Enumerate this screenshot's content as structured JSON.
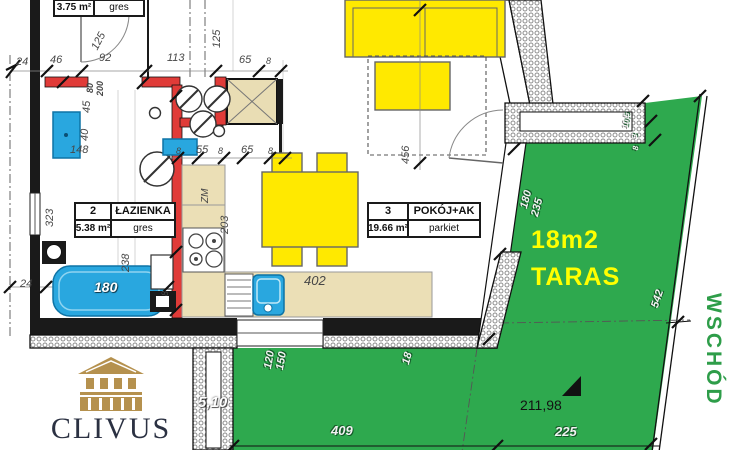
{
  "plan": {
    "rooms": [
      {
        "no": "",
        "name": "",
        "area": "3.75 m²",
        "floor": "gres"
      },
      {
        "no": "2",
        "name": "ŁAZIENKA",
        "area": "5.38 m²",
        "floor": "gres"
      },
      {
        "no": "3",
        "name": "POKÓJ+AK",
        "area": "19.66 m²",
        "floor": "parkiet"
      }
    ],
    "terrace": {
      "size_label": "18m2",
      "name": "TARAS",
      "elevation": "211,98"
    },
    "compass_label": "WSCHÓD",
    "brand": "CLIVUS"
  },
  "dims": [
    {
      "t": "24",
      "x": 16,
      "y": 57
    },
    {
      "t": "46",
      "x": 50,
      "y": 55
    },
    {
      "t": "92",
      "x": 99,
      "y": 53
    },
    {
      "t": "113",
      "x": 167,
      "y": 53
    },
    {
      "t": "65",
      "x": 239,
      "y": 55
    },
    {
      "t": "8",
      "x": 266,
      "y": 57,
      "s": 9
    },
    {
      "t": "125",
      "x": 90,
      "y": 47,
      "r": -62
    },
    {
      "t": "125",
      "x": 212,
      "y": 48,
      "r": -90
    },
    {
      "t": "80",
      "x": 86,
      "y": 93,
      "r": -90,
      "s": 9,
      "b": 1
    },
    {
      "t": "200",
      "x": 96,
      "y": 96,
      "r": -90,
      "s": 9,
      "b": 1
    },
    {
      "t": "45",
      "x": 82,
      "y": 113,
      "r": -90
    },
    {
      "t": "40",
      "x": 80,
      "y": 141,
      "r": -90
    },
    {
      "t": "148",
      "x": 70,
      "y": 145
    },
    {
      "t": "8",
      "x": 176,
      "y": 147,
      "s": 9
    },
    {
      "t": "55",
      "x": 196,
      "y": 145
    },
    {
      "t": "8",
      "x": 218,
      "y": 147,
      "s": 9
    },
    {
      "t": "65",
      "x": 241,
      "y": 145
    },
    {
      "t": "8",
      "x": 268,
      "y": 147,
      "s": 9
    },
    {
      "t": "323",
      "x": 45,
      "y": 227,
      "r": -90
    },
    {
      "t": "238",
      "x": 121,
      "y": 272,
      "r": -90
    },
    {
      "t": "24",
      "x": 20,
      "y": 279
    },
    {
      "t": "8",
      "x": 161,
      "y": 296,
      "r": -90,
      "s": 9
    },
    {
      "t": "ZM",
      "x": 201,
      "y": 203,
      "r": -90,
      "s": 10
    },
    {
      "t": "203",
      "x": 220,
      "y": 234,
      "r": -90
    },
    {
      "t": "402",
      "x": 304,
      "y": 274,
      "s": 13
    },
    {
      "t": "456",
      "x": 401,
      "y": 164,
      "r": -90
    },
    {
      "t": "180",
      "x": 94,
      "y": 280,
      "c": "wht",
      "s": 14
    },
    {
      "t": "180",
      "x": 519,
      "y": 207,
      "r": -75,
      "c": "emb"
    },
    {
      "t": "235",
      "x": 530,
      "y": 215,
      "r": -75,
      "c": "emb"
    },
    {
      "t": "542",
      "x": 650,
      "y": 306,
      "r": -72,
      "c": "emb"
    },
    {
      "t": "10,5",
      "x": 622,
      "y": 128,
      "r": -85,
      "c": "emb",
      "s": 8
    },
    {
      "t": "3",
      "x": 631,
      "y": 138,
      "r": -85,
      "c": "emb",
      "s": 8
    },
    {
      "t": "8",
      "x": 632,
      "y": 150,
      "r": -85,
      "c": "emb",
      "s": 8
    },
    {
      "t": "120",
      "x": 263,
      "y": 368,
      "r": -80,
      "c": "emb"
    },
    {
      "t": "150",
      "x": 275,
      "y": 369,
      "r": -80,
      "c": "emb"
    },
    {
      "t": "18",
      "x": 401,
      "y": 363,
      "r": -75,
      "c": "emb"
    },
    {
      "t": "409",
      "x": 331,
      "y": 424,
      "c": "emb",
      "s": 13
    },
    {
      "t": "225",
      "x": 555,
      "y": 425,
      "c": "emb",
      "s": 13
    },
    {
      "t": "5,10",
      "x": 198,
      "y": 395,
      "c": "wht",
      "s": 15
    }
  ],
  "colors": {
    "terrace_green": "#2ea94e",
    "furniture_yellow": "#ffe900",
    "wall_red": "#e03b38",
    "fixture_blue": "#29a7df",
    "counter_beige": "#ebdfb6",
    "label_yellow": "#ffff00",
    "compass_green": "#2e9d49",
    "logo_gold": "#b5914e",
    "logo_navy": "#2b3142"
  }
}
